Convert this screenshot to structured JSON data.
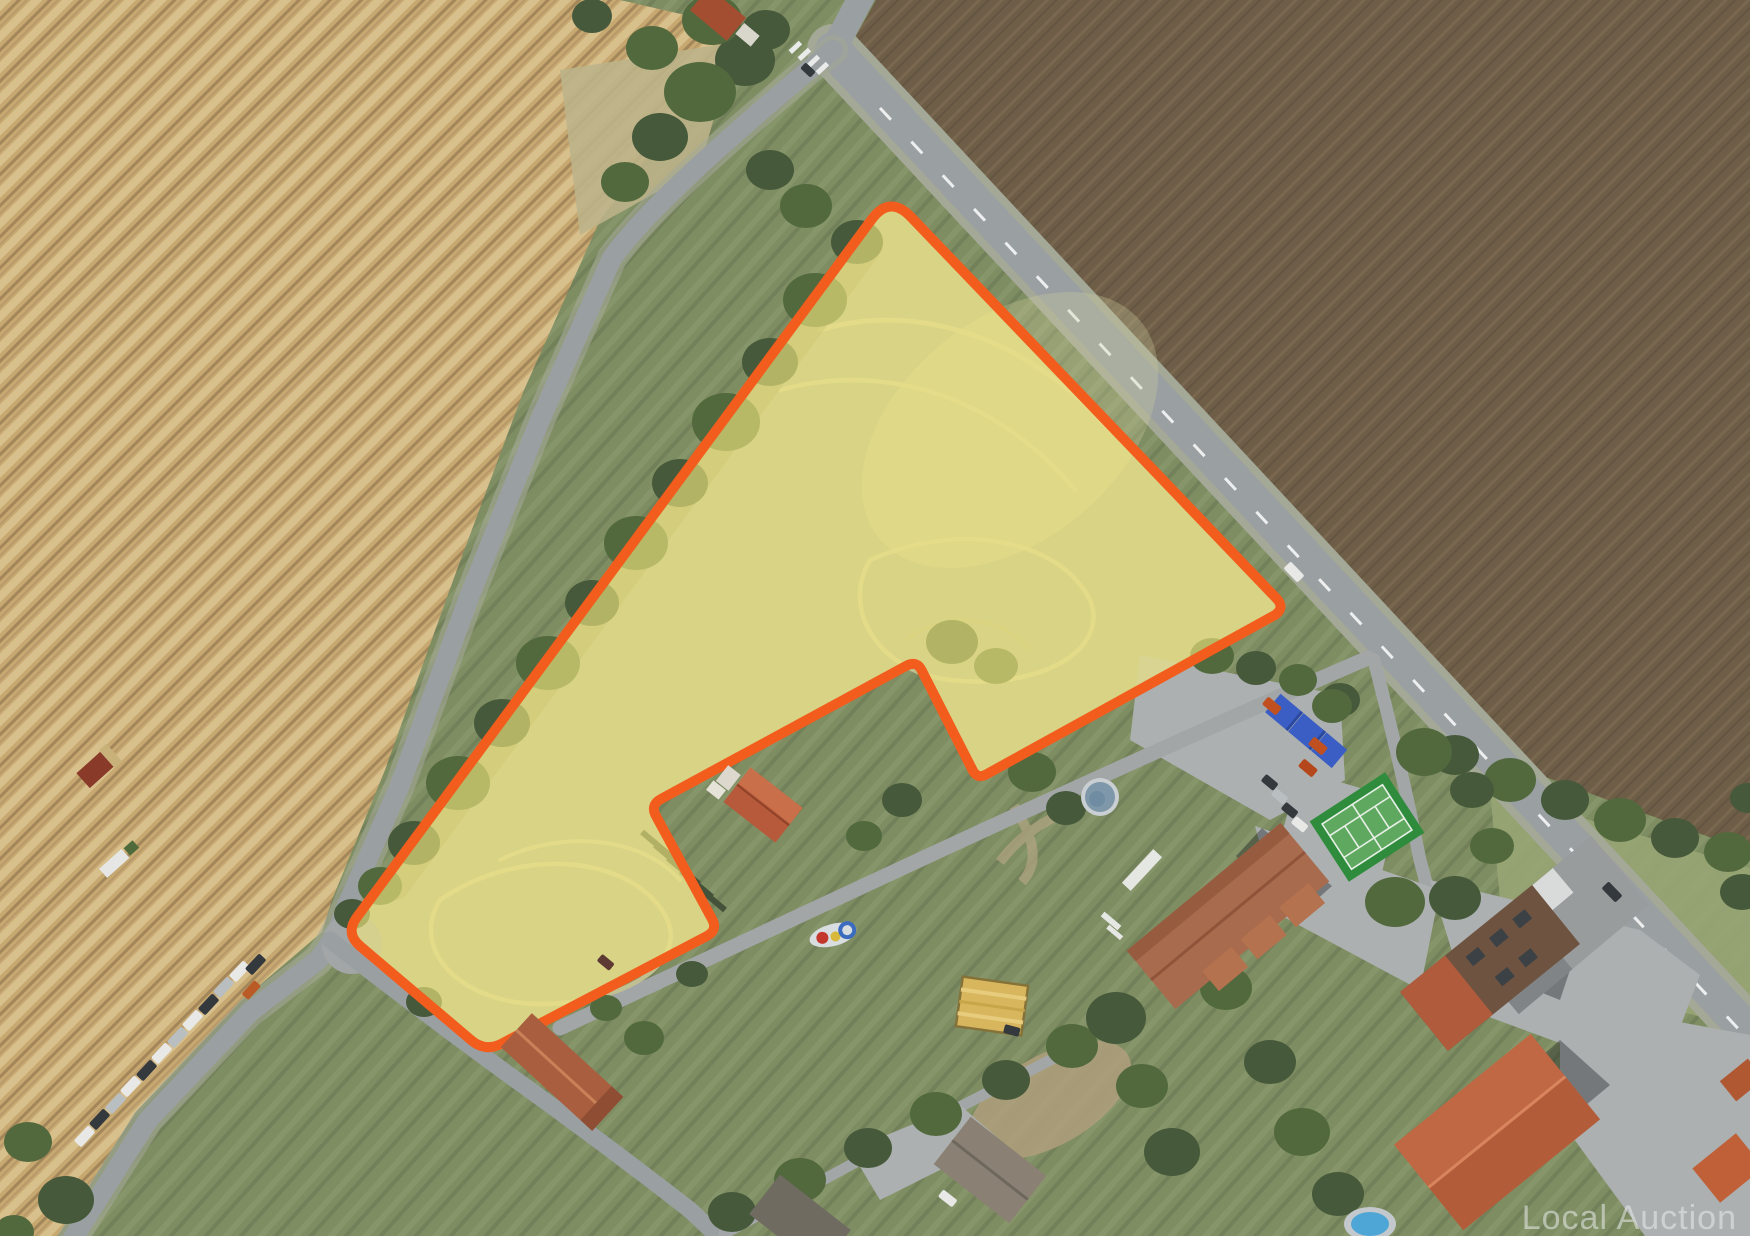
{
  "watermark": {
    "text": "Local Auction",
    "color": "#EAEDED",
    "opacity": "0.55",
    "font_size": "34"
  },
  "parcel": {
    "path": "M 872,219 Q 890,195 911,217 L 1277,599 Q 1285,608 1275,615 L 987,774 Q 977,780 972,769 L 922,671 Q 917,660 906,666 L 661,799 Q 650,805 656,816 L 712,919 Q 718,930 707,936 L 501,1044 Q 485,1052 471,1040 L 360,946 Q 345,933 357,917 Z",
    "fill": "#F6EA80",
    "fill_opacity": "0.62",
    "stroke": "#F25D1E",
    "stroke_width": "10"
  },
  "features": {
    "wheat_field_color": "#C6A870",
    "ploughed_field_color": "#6E5E48",
    "grass_color": "#7E8D62",
    "road_color": "#9A9FA2",
    "tennis_court_color": "#2F8C3C",
    "tennis_court_inner_color": "#5FA85F",
    "pool_color": "#7E98AA",
    "tarp_color": "#3A5EC4",
    "hay_square_color": "#D8B65D",
    "farm_complex_roof_color": "#A96B4D",
    "orange_roof_color": "#C06844",
    "notch_house_roof_color": "#B65A3B",
    "barn_roof_color": "#A95F3F"
  }
}
